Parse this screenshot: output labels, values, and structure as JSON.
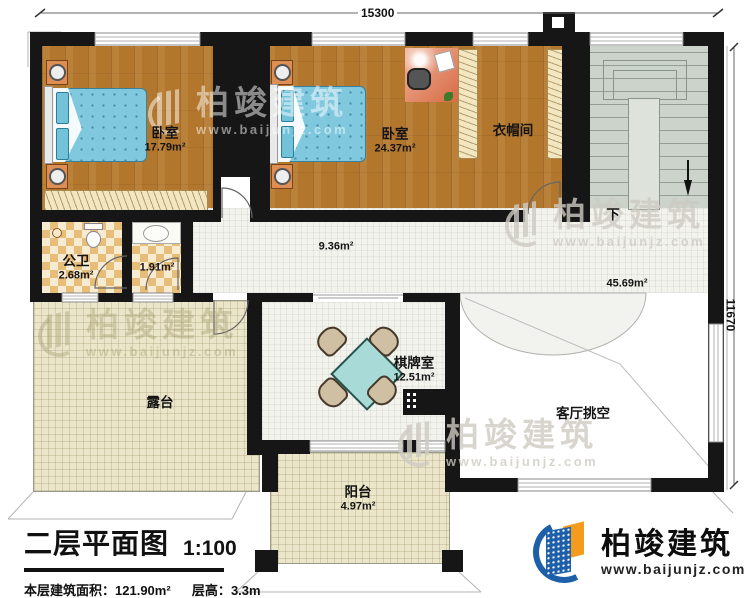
{
  "title": {
    "text": "二层平面图",
    "scale": "1:100",
    "area_label": "本层建筑面积：",
    "area_value": "121.90m²",
    "height_label": "层高：",
    "height_value": "3.3m"
  },
  "brand": {
    "name": "柏竣建筑",
    "url": "www.baijunjz.com"
  },
  "watermark": {
    "text": "柏竣建筑",
    "url": "www.baijunjz.com"
  },
  "dimensions": {
    "top": "15300",
    "right": "11670"
  },
  "stairs": {
    "down_label": "下"
  },
  "rooms": {
    "bedroom1": {
      "name": "卧室",
      "area": "17.79m²"
    },
    "bedroom2": {
      "name": "卧室",
      "area": "24.37m²"
    },
    "cloakroom": {
      "name": "衣帽间",
      "area": ""
    },
    "bathroom": {
      "name": "公卫",
      "area": "2.68m²"
    },
    "washroom": {
      "name": "",
      "area": "1.91m²"
    },
    "corridor": {
      "name": "",
      "area": "9.36m²"
    },
    "hall": {
      "name": "",
      "area": "45.69m²"
    },
    "terrace": {
      "name": "露台",
      "area": ""
    },
    "chess": {
      "name": "棋牌室",
      "area": "12.51m²"
    },
    "void": {
      "name": "客厅挑空",
      "area": ""
    },
    "balcony": {
      "name": "阳台",
      "area": "4.97m²"
    }
  },
  "colors": {
    "wall": "#161616",
    "wood_floor": "#b2762d",
    "bed_blue": "#7fc8de",
    "stair_gray": "#ccd3cb",
    "brand_blue": "#1d5fa8",
    "brand_orange": "#f29b1d",
    "table_teal": "#a8dbd7"
  }
}
